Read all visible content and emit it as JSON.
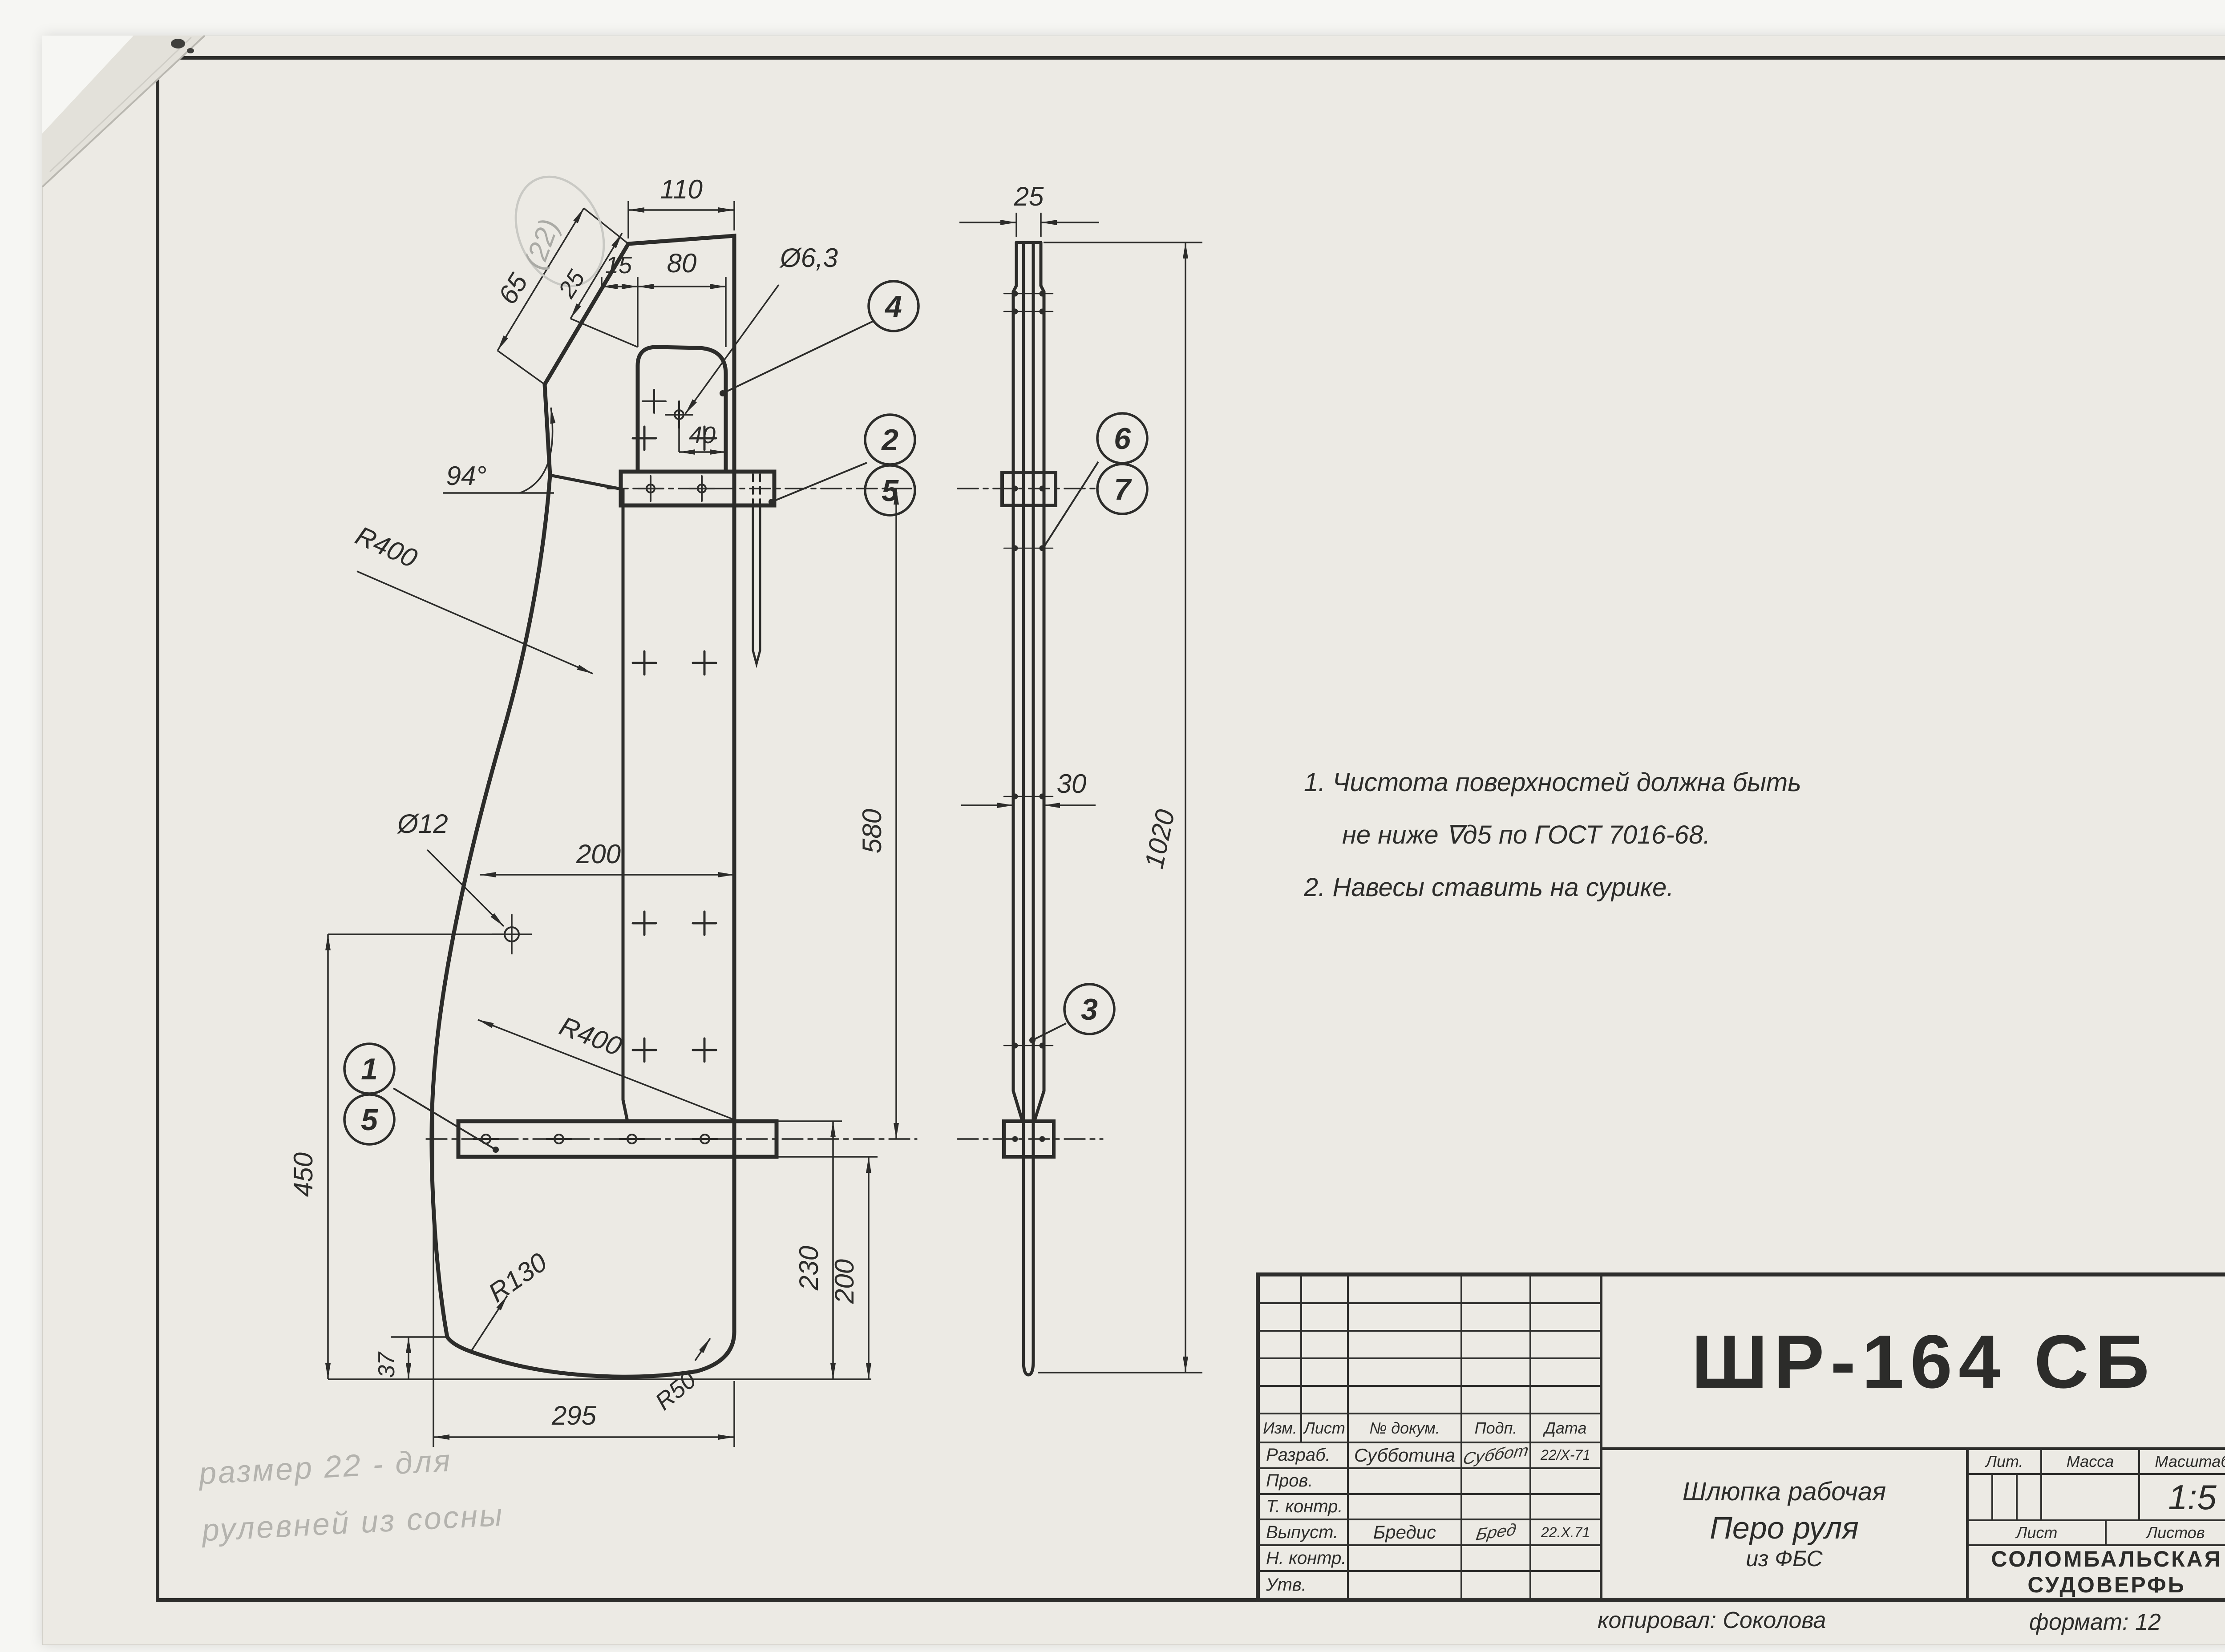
{
  "sheet_left": {
    "doc_number": "ШР-164 СБ",
    "notes_line1": "1. Чистота поверхностей должна быть",
    "notes_line2": "не ниже ∇д5 по ГОСТ 7016-68.",
    "notes_line3": "2. Навесы ставить на сурике.",
    "pencil_line1": "размер 22 - для",
    "pencil_line2": "рулевней из сосны",
    "pencil_dim": "(22)",
    "copied": "копировал: Соколова",
    "format": "формат: 12"
  },
  "sheet_right": {
    "doc_number": "ШР-164",
    "copied": "Копировал: Соколова",
    "format": "Формат: 11"
  },
  "title_common": {
    "izm": "Изм.",
    "list": "Лист",
    "ndokum": "№ докум.",
    "podp": "Подп.",
    "data": "Дата",
    "razrab": "Разраб.",
    "prov": "Пров.",
    "tkontr": "Т. контр.",
    "vypust": "Выпуст.",
    "nkontr": "Н. контр.",
    "utv": "Утв.",
    "razrab_name": "Субботина",
    "razrab_sign": "Суббот",
    "razrab_date": "22/X-71",
    "vypust_name": "Бредис",
    "vypust_sign": "Бред",
    "vypust_date": "22.X.71",
    "product": "Шлюпка рабочая",
    "part1": "Перо руля",
    "part2": "из ФБС",
    "lit": "Лит.",
    "massa": "Масса",
    "masshtab": "Масштаб",
    "scale": "1:5",
    "list2": "Лист",
    "listov": "Листов",
    "company1": "СОЛОМБАЛЬСКАЯ",
    "company2": "СУДОВЕРФЬ"
  },
  "spec": {
    "h_format": "формат",
    "h_zona": "зона",
    "h_poz": "Поз.",
    "h_obozn": "Обозначение",
    "h_naim": "Наименование",
    "h_kol": "Кол.",
    "h_prim1": "Приме-",
    "h_prim2": "чание",
    "rows": [
      {
        "n": "Сборочные единицы"
      },
      {
        "f": "12",
        "p": "1",
        "o": "ШР-162",
        "n": "Навес рулевой нижний",
        "k": "1"
      },
      {
        "f": "11",
        "p": "2",
        "o": "ШР-163",
        "n": "Навес рулевой верхний",
        "k": "1"
      },
      {},
      {
        "n": "Детали"
      },
      {
        "f": "Б4",
        "p": "3",
        "n": "Перо руля δ=10",
        "n2a": "фанера",
        "n2b": "ФБС",
        "k": "1"
      },
      {
        "f": "Б4",
        "p": "4",
        "n": "Щека 10×110×808 фанера ФБС",
        "k": "2",
        "pr": "из отходов"
      },
      {
        "f": "Б4",
        "p": "5",
        "n": "гвоздь К 5×45  Ст. 3",
        "pr": "из гвоздя"
      },
      {
        "n": "оцинкованный",
        "k": "6",
        "pra": "К5×150",
        "prb": "ГОСТ 4028-63"
      },
      {},
      {
        "n": "Стандартные изделия"
      },
      {
        "f": "Б4",
        "p": "6",
        "n": "гвоздь заклёпочный"
      },
      {
        "n": "3,5×45  Н153-3-68",
        "k": "10"
      },
      {
        "f": "Б4",
        "p": "7",
        "n": "Шайба 14×3,3"
      },
      {
        "n": "Н153-4-68",
        "k": "10"
      }
    ]
  },
  "dims": {
    "d110": "110",
    "d15": "15",
    "d80": "80",
    "d63": "Ø6,3",
    "d65": "65",
    "d25": "25",
    "d40": "40",
    "a94": "94°",
    "r400a": "R400",
    "r400b": "R400",
    "d12": "Ø12",
    "d200": "200",
    "d580": "580",
    "d450": "450",
    "d37": "37",
    "d295": "295",
    "d230": "230",
    "d200b": "200",
    "r130": "R130",
    "r50": "R50",
    "s25": "25",
    "s30": "30",
    "s1020": "1020"
  },
  "balloons": {
    "b1": "1",
    "b2": "2",
    "b3": "3",
    "b4": "4",
    "b5": "5",
    "b6": "6",
    "b7": "7"
  }
}
